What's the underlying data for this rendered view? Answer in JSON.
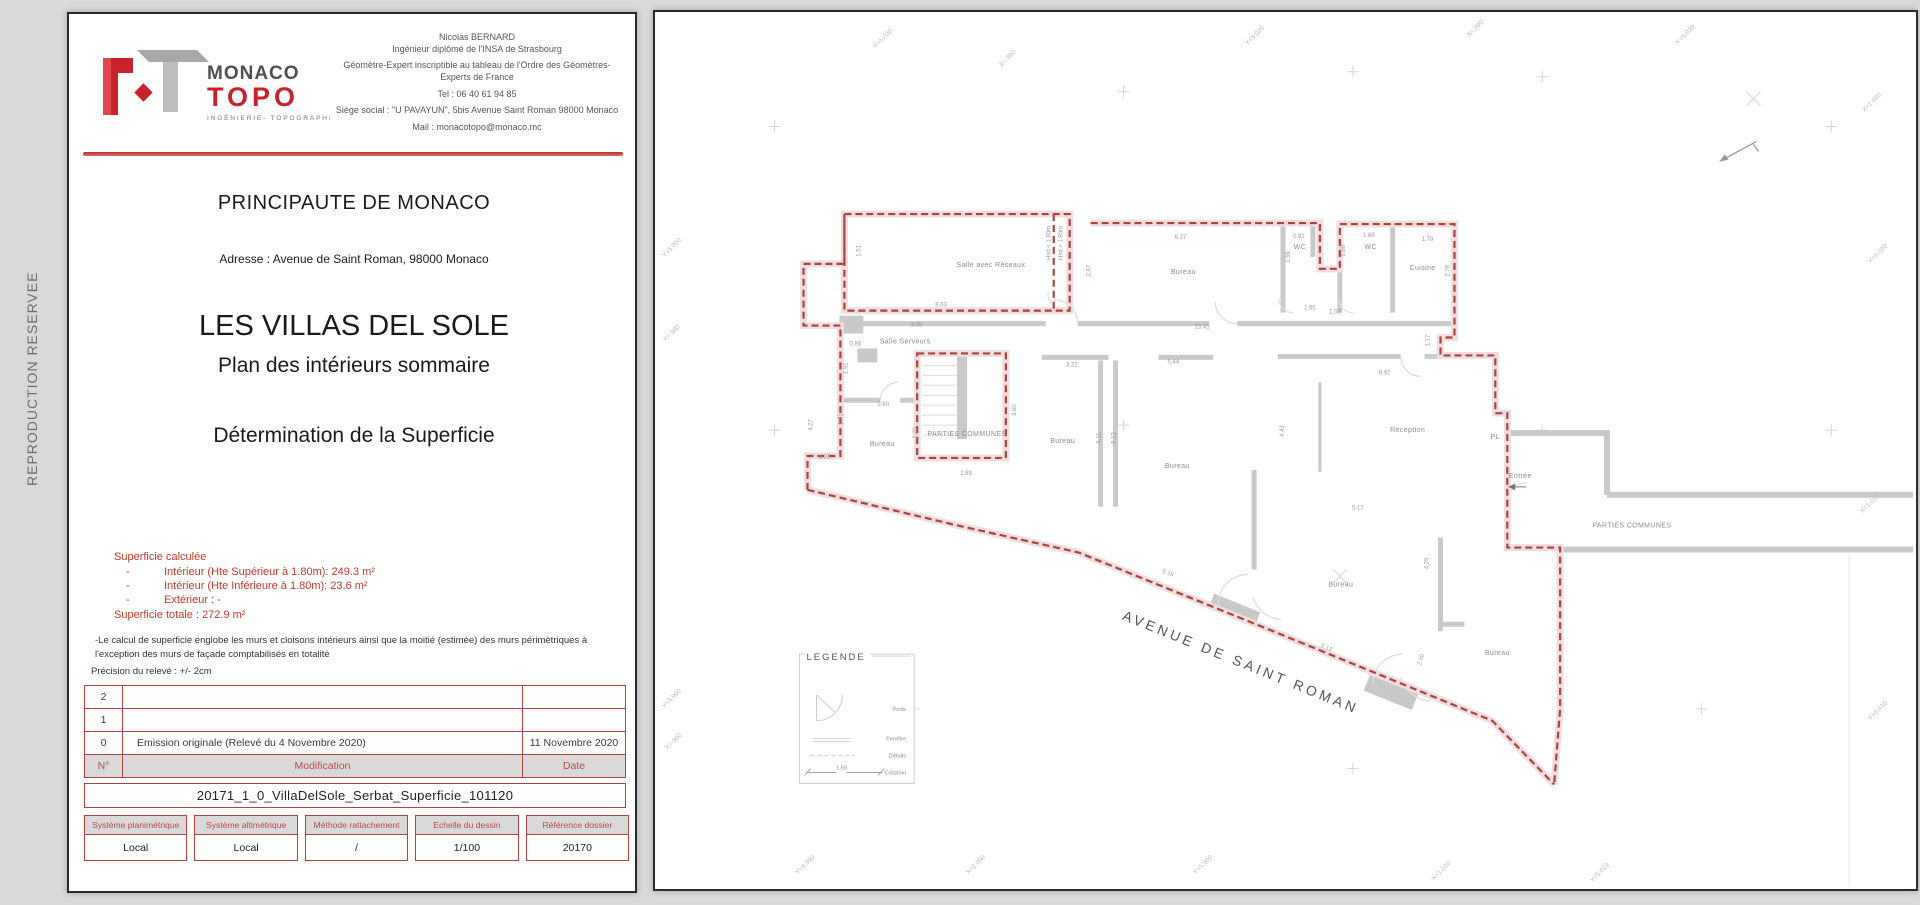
{
  "side_strip": {
    "label": "REPRODUCTION RESERVEE"
  },
  "title_block": {
    "logo": {
      "brand_top": "MONACO",
      "brand_bottom": "TOPO",
      "tagline": "INGÉNIERIE- TOPOGRAPHIE"
    },
    "contact": {
      "lines": [
        "Nicolas BERNARD",
        "Ingénieur diplômé de l'INSA de Strasbourg",
        "Géomètre-Expert inscriptible au tableau de l'Ordre des Géomètres-Experts de France",
        "Tel : 06 40 61 94 85",
        "Siège social : \"U PAVAYUN\", 5bis Avenue Saint Roman 98000 Monaco",
        "Mail : monacotopo@monaco.mc"
      ]
    },
    "country": "PRINCIPAUTE DE MONACO",
    "address": "Adresse : Avenue de Saint Roman, 98000 Monaco",
    "project": "LES VILLAS DEL SOLE",
    "subtitle1": "Plan des intérieurs sommaire",
    "subtitle2": "Détermination de la Superficie",
    "superficie": {
      "heading": "Superficie calculée",
      "bullet": "-",
      "items": [
        "Intérieur (Hte Supérieur à 1.80m): 249.3 m²",
        "Intérieur (Hte Inférieure à 1.80m): 23.6 m²",
        "Extérieur : -"
      ],
      "total": "Superficie totale : 272.9 m²"
    },
    "notes": [
      "-Le calcul de superficie englobe les murs et cloisons intérieurs ainsi que la moitié (estimée) des murs périmètriques à l'exception des murs de façade comptabilisés en totalité",
      "Précision du relevé : +/- 2cm"
    ],
    "revisions": {
      "headers": {
        "num": "N°",
        "modification": "Modification",
        "date": "Date"
      },
      "rows": [
        {
          "num": "2",
          "modification": "",
          "date": ""
        },
        {
          "num": "1",
          "modification": "",
          "date": ""
        },
        {
          "num": "0",
          "modification": "Emission originale (Relevé du 4 Novembre 2020)",
          "date": "11 Novembre 2020"
        }
      ]
    },
    "filename": "20171_1_0_VillaDelSole_Serbat_Superficie_101120",
    "meta": {
      "columns": [
        {
          "label": "Système planimétrique",
          "value": "Local"
        },
        {
          "label": "Système altimétrique",
          "value": "Local"
        },
        {
          "label": "Méthode rattachement",
          "value": "/"
        },
        {
          "label": "Echelle du dessin",
          "value": "1/100"
        },
        {
          "label": "Référence dossier",
          "value": "20170"
        }
      ]
    }
  },
  "plan": {
    "street": "AVENUE DE SAINT ROMAN",
    "legend": {
      "title": "LEGENDE",
      "items": [
        "Porte",
        "Fenêtre",
        "Détails",
        "Cotation"
      ],
      "sample_dim": "1.59"
    },
    "rooms": [
      {
        "t": "Salle avec Réseaux",
        "x": 337,
        "y": 256
      },
      {
        "t": "Bureau",
        "x": 530,
        "y": 263
      },
      {
        "t": "WC",
        "x": 647,
        "y": 238
      },
      {
        "t": "WC",
        "x": 718,
        "y": 238
      },
      {
        "t": "Cuisine",
        "x": 770,
        "y": 259
      },
      {
        "t": "Salle Serveurs",
        "x": 251,
        "y": 333
      },
      {
        "t": "PARTIES COMMUNES",
        "x": 313,
        "y": 426,
        "s": 5.5
      },
      {
        "t": "Bureau",
        "x": 228,
        "y": 436
      },
      {
        "t": "Bureau",
        "x": 409,
        "y": 433
      },
      {
        "t": "Bureau",
        "x": 524,
        "y": 458
      },
      {
        "t": "Réception",
        "x": 755,
        "y": 422
      },
      {
        "t": "PL",
        "x": 843,
        "y": 429,
        "s": 5
      },
      {
        "t": "Entrée",
        "x": 868,
        "y": 468,
        "s": 6.5
      },
      {
        "t": "PARTIES COMMUNES",
        "x": 980,
        "y": 518,
        "s": 5.5
      },
      {
        "t": "Bureau",
        "x": 688,
        "y": 577
      },
      {
        "t": "Bureau",
        "x": 845,
        "y": 646
      }
    ],
    "dims": [
      {
        "t": "8.63",
        "x": 287,
        "y": 296
      },
      {
        "t": "1.51",
        "x": 206,
        "y": 240,
        "r": -90
      },
      {
        "t": "Hsd < 1.80m",
        "x": 397,
        "y": 232,
        "r": -90,
        "s": 4.5
      },
      {
        "t": "Hsd > 1.80m",
        "x": 409,
        "y": 232,
        "r": -90,
        "s": 4.5
      },
      {
        "t": "2.47",
        "x": 437,
        "y": 260,
        "r": -90
      },
      {
        "t": "3.05",
        "x": 262,
        "y": 316
      },
      {
        "t": "6.37",
        "x": 527,
        "y": 228
      },
      {
        "t": "0.91",
        "x": 646,
        "y": 227
      },
      {
        "t": "1.56",
        "x": 637,
        "y": 246,
        "r": -90
      },
      {
        "t": "1.68",
        "x": 716,
        "y": 226
      },
      {
        "t": "1.00",
        "x": 692,
        "y": 240,
        "r": -90
      },
      {
        "t": "1.79",
        "x": 775,
        "y": 230
      },
      {
        "t": "2.78",
        "x": 797,
        "y": 260,
        "r": -90
      },
      {
        "t": "1.65",
        "x": 657,
        "y": 299
      },
      {
        "t": "1.03",
        "x": 682,
        "y": 303
      },
      {
        "t": "15.41",
        "x": 549,
        "y": 318
      },
      {
        "t": "1.17",
        "x": 777,
        "y": 330,
        "r": -90
      },
      {
        "t": "0.86",
        "x": 201,
        "y": 335
      },
      {
        "t": "1.91",
        "x": 193,
        "y": 358,
        "r": -90
      },
      {
        "t": "2.60",
        "x": 229,
        "y": 396
      },
      {
        "t": "1.71",
        "x": 188,
        "y": 409,
        "r": -90
      },
      {
        "t": "4.27",
        "x": 158,
        "y": 415,
        "r": -90
      },
      {
        "t": "1.07",
        "x": 170,
        "y": 449
      },
      {
        "t": "2.20",
        "x": 263,
        "y": 423,
        "r": -90
      },
      {
        "t": "3.60",
        "x": 362,
        "y": 400,
        "r": -90
      },
      {
        "t": "2.89",
        "x": 312,
        "y": 465
      },
      {
        "t": "3.22",
        "x": 418,
        "y": 356
      },
      {
        "t": "5.11",
        "x": 447,
        "y": 428,
        "r": -90
      },
      {
        "t": "5.13",
        "x": 462,
        "y": 428,
        "r": -90
      },
      {
        "t": "5.44",
        "x": 520,
        "y": 353
      },
      {
        "t": "4.43",
        "x": 631,
        "y": 421,
        "r": -90
      },
      {
        "t": "6.97",
        "x": 732,
        "y": 364
      },
      {
        "t": "5.17",
        "x": 705,
        "y": 500
      },
      {
        "t": "5.16",
        "x": 514,
        "y": 565,
        "r": 24
      },
      {
        "t": "6.12",
        "x": 673,
        "y": 640,
        "r": 24
      },
      {
        "t": "4.29",
        "x": 776,
        "y": 554,
        "r": -90
      },
      {
        "t": "2.30",
        "x": 770,
        "y": 651,
        "r": -75
      }
    ],
    "grid_labels": [
      {
        "t": "Y=5.030",
        "x": 230,
        "y": 28,
        "r": -45
      },
      {
        "t": "X=.980",
        "x": 355,
        "y": 48,
        "r": -45
      },
      {
        "t": "Y=5.020",
        "x": 603,
        "y": 25,
        "r": -45
      },
      {
        "t": "X=.990",
        "x": 824,
        "y": 18,
        "r": -45
      },
      {
        "t": "Y=5.030",
        "x": 1035,
        "y": 24,
        "r": -45
      },
      {
        "t": "X=1.000",
        "x": 1222,
        "y": 92,
        "r": -45
      },
      {
        "t": "Y=5.000",
        "x": 18,
        "y": 238,
        "r": -45
      },
      {
        "t": "X=.980",
        "x": 18,
        "y": 324,
        "r": -45
      },
      {
        "t": "Y=4.990",
        "x": 18,
        "y": 691,
        "r": -45
      },
      {
        "t": "X=.990",
        "x": 20,
        "y": 734,
        "r": -45
      },
      {
        "t": "Y=5.020",
        "x": 1228,
        "y": 244,
        "r": -45
      },
      {
        "t": "X=1.010",
        "x": 1220,
        "y": 495,
        "r": -45
      },
      {
        "t": "Y=5.010",
        "x": 1228,
        "y": 703,
        "r": -45
      },
      {
        "t": "Y=4.990",
        "x": 152,
        "y": 858,
        "r": -45
      },
      {
        "t": "X=1.000",
        "x": 323,
        "y": 858,
        "r": -45
      },
      {
        "t": "Y=5.000",
        "x": 551,
        "y": 858,
        "r": -45
      },
      {
        "t": "X=1.010",
        "x": 790,
        "y": 864,
        "r": -45
      },
      {
        "t": "Y=5.010",
        "x": 949,
        "y": 866,
        "r": -45
      }
    ]
  }
}
